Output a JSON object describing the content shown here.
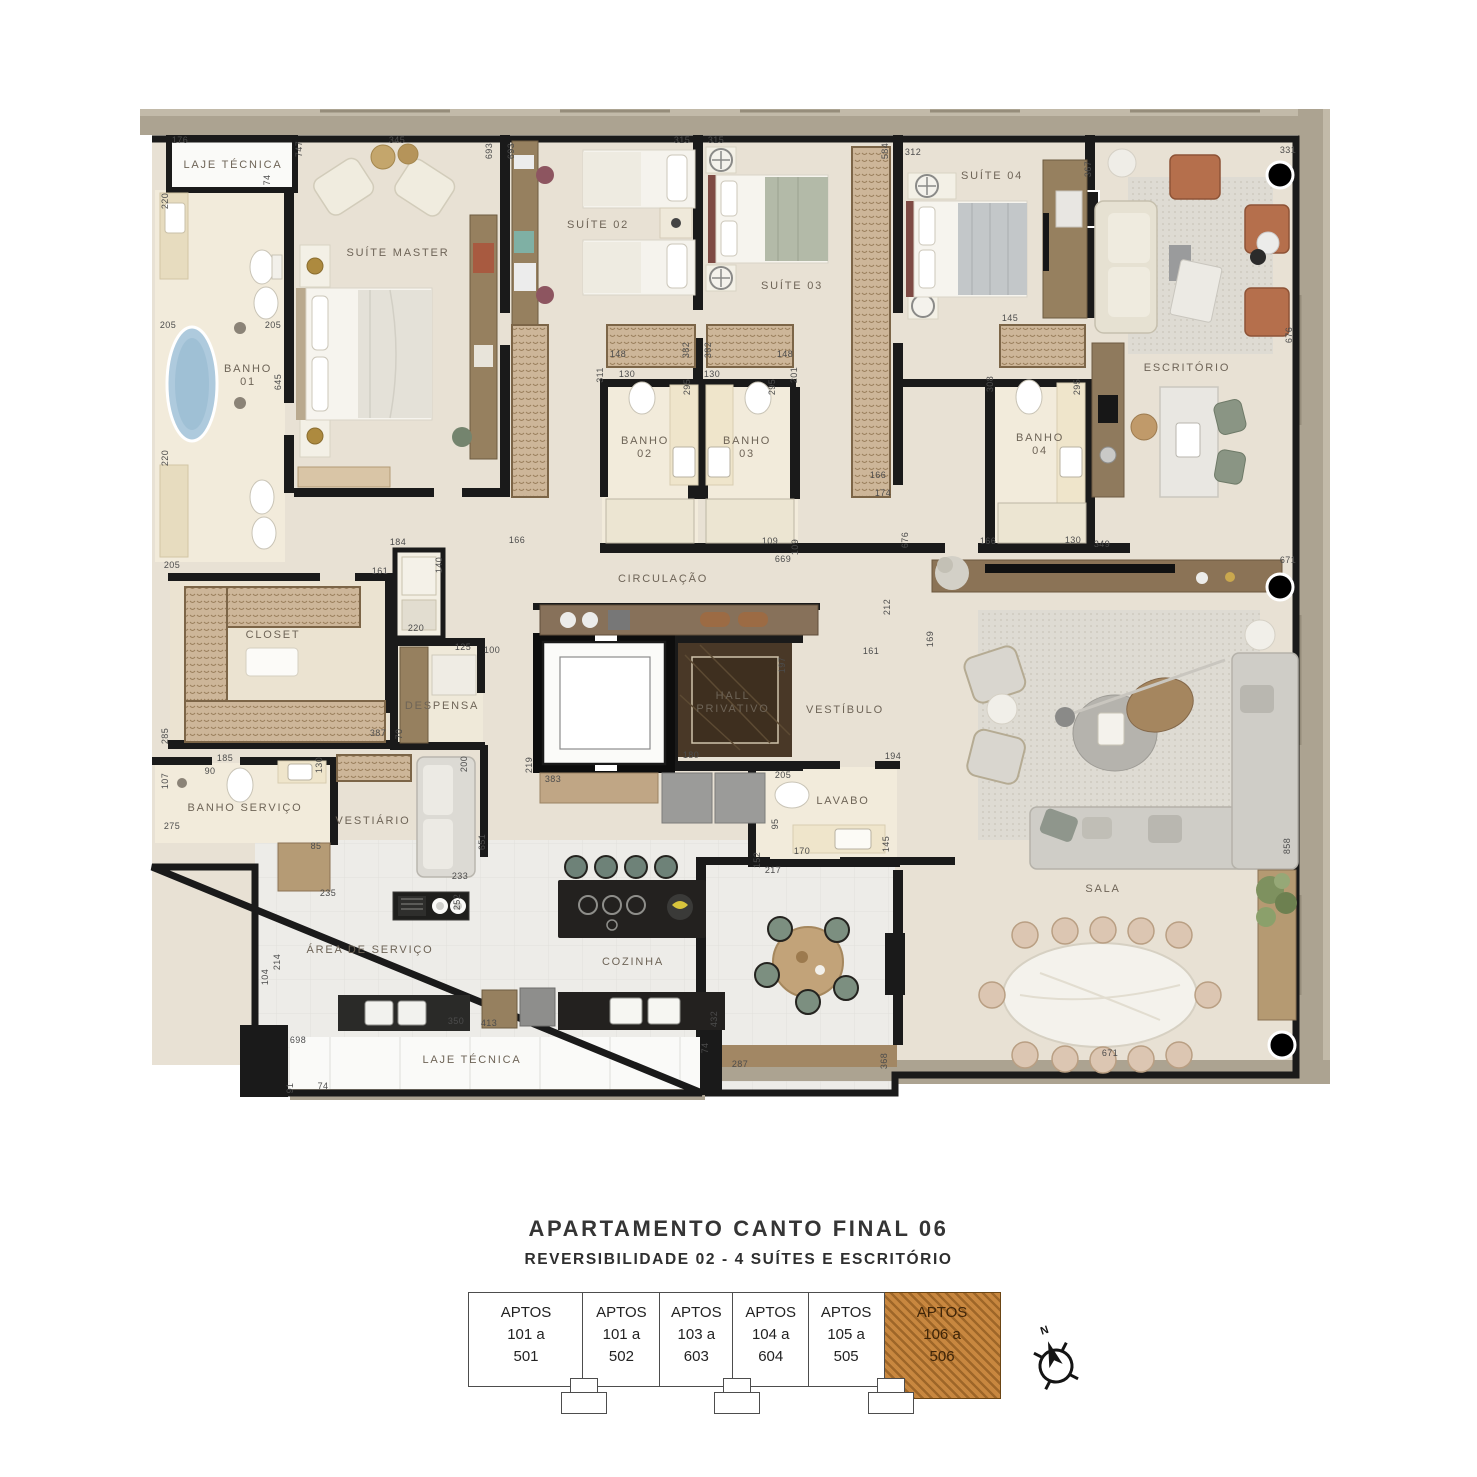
{
  "title": "APARTAMENTO CANTO FINAL 06",
  "subtitle": "REVERSIBILIDADE 02 -  4 SUÍTES E ESCRITÓRIO",
  "colors": {
    "floor": "#e8e1d4",
    "bath_floor": "#f2ebdb",
    "wall": "#1a1a1a",
    "facade": "#aca391",
    "wardrobe": "#cdb699",
    "wood": "#96805f",
    "highlight_orange": "#c8873f",
    "marble_hall": "#493827",
    "tub_blue": "#aecadd"
  },
  "plan": {
    "room_labels": [
      {
        "label": "LAJE TÉCNICA",
        "x": 93,
        "y": 73
      },
      {
        "label": "BANHO\n01",
        "x": 108,
        "y": 277
      },
      {
        "label": "SUÍTE MASTER",
        "x": 258,
        "y": 161
      },
      {
        "label": "SUÍTE 02",
        "x": 458,
        "y": 133
      },
      {
        "label": "SUÍTE 03",
        "x": 652,
        "y": 194
      },
      {
        "label": "SUÍTE 04",
        "x": 852,
        "y": 84
      },
      {
        "label": "ESCRITÓRIO",
        "x": 1047,
        "y": 276
      },
      {
        "label": "BANHO\n02",
        "x": 505,
        "y": 349
      },
      {
        "label": "BANHO\n03",
        "x": 607,
        "y": 349
      },
      {
        "label": "BANHO\n04",
        "x": 900,
        "y": 346
      },
      {
        "label": "CLOSET",
        "x": 133,
        "y": 543
      },
      {
        "label": "CIRCULAÇÃO",
        "x": 523,
        "y": 487
      },
      {
        "label": "DESPENSA",
        "x": 302,
        "y": 614
      },
      {
        "label": "HALL\nPRIVATIVO",
        "x": 593,
        "y": 604,
        "w": 1
      },
      {
        "label": "VESTÍBULO",
        "x": 705,
        "y": 618
      },
      {
        "label": "BANHO SERVIÇO",
        "x": 105,
        "y": 716
      },
      {
        "label": "VESTIÁRIO",
        "x": 233,
        "y": 729
      },
      {
        "label": "LAVABO",
        "x": 703,
        "y": 709
      },
      {
        "label": "ÁREA DE SERVIÇO",
        "x": 230,
        "y": 858
      },
      {
        "label": "COZINHA",
        "x": 493,
        "y": 870
      },
      {
        "label": "SALA",
        "x": 963,
        "y": 797
      },
      {
        "label": "LAJE TÉCNICA",
        "x": 332,
        "y": 968
      }
    ],
    "dims": [
      {
        "v": "176",
        "x": 40,
        "y": 48
      },
      {
        "v": "74",
        "x": 130,
        "y": 85,
        "r": 1
      },
      {
        "v": "747",
        "x": 162,
        "y": 54,
        "r": 1
      },
      {
        "v": "345",
        "x": 257,
        "y": 48
      },
      {
        "v": "693",
        "x": 352,
        "y": 56,
        "r": 1
      },
      {
        "v": "693",
        "x": 374,
        "y": 56,
        "r": 1
      },
      {
        "v": "315",
        "x": 542,
        "y": 48
      },
      {
        "v": "315",
        "x": 576,
        "y": 48
      },
      {
        "v": "584",
        "x": 748,
        "y": 56,
        "r": 1
      },
      {
        "v": "312",
        "x": 773,
        "y": 60
      },
      {
        "v": "367",
        "x": 951,
        "y": 74,
        "r": 1
      },
      {
        "v": "331",
        "x": 1148,
        "y": 58
      },
      {
        "v": "220",
        "x": 28,
        "y": 106,
        "r": 1
      },
      {
        "v": "205",
        "x": 28,
        "y": 233
      },
      {
        "v": "205",
        "x": 133,
        "y": 233
      },
      {
        "v": "645",
        "x": 141,
        "y": 287,
        "r": 1
      },
      {
        "v": "220",
        "x": 28,
        "y": 363,
        "r": 1
      },
      {
        "v": "205",
        "x": 32,
        "y": 473
      },
      {
        "v": "184",
        "x": 258,
        "y": 450
      },
      {
        "v": "161",
        "x": 240,
        "y": 479
      },
      {
        "v": "140",
        "x": 302,
        "y": 470,
        "r": 1
      },
      {
        "v": "220",
        "x": 276,
        "y": 536
      },
      {
        "v": "125",
        "x": 323,
        "y": 555
      },
      {
        "v": "100",
        "x": 352,
        "y": 558
      },
      {
        "v": "285",
        "x": 28,
        "y": 641,
        "r": 1
      },
      {
        "v": "387",
        "x": 238,
        "y": 641
      },
      {
        "v": "70",
        "x": 262,
        "y": 639,
        "r": 1
      },
      {
        "v": "107",
        "x": 28,
        "y": 686,
        "r": 1
      },
      {
        "v": "90",
        "x": 70,
        "y": 679
      },
      {
        "v": "185",
        "x": 85,
        "y": 666
      },
      {
        "v": "130",
        "x": 182,
        "y": 670,
        "r": 1
      },
      {
        "v": "275",
        "x": 32,
        "y": 734
      },
      {
        "v": "85",
        "x": 176,
        "y": 754
      },
      {
        "v": "235",
        "x": 188,
        "y": 801
      },
      {
        "v": "200",
        "x": 327,
        "y": 669,
        "r": 1
      },
      {
        "v": "233",
        "x": 320,
        "y": 784
      },
      {
        "v": "651",
        "x": 345,
        "y": 747,
        "r": 1
      },
      {
        "v": "252",
        "x": 320,
        "y": 807,
        "r": 1
      },
      {
        "v": "166",
        "x": 377,
        "y": 448
      },
      {
        "v": "148",
        "x": 478,
        "y": 262
      },
      {
        "v": "382",
        "x": 549,
        "y": 255,
        "r": 1
      },
      {
        "v": "311",
        "x": 463,
        "y": 280,
        "r": 1
      },
      {
        "v": "130",
        "x": 487,
        "y": 282
      },
      {
        "v": "295",
        "x": 550,
        "y": 292,
        "r": 1
      },
      {
        "v": "382",
        "x": 571,
        "y": 255,
        "r": 1
      },
      {
        "v": "148",
        "x": 645,
        "y": 262
      },
      {
        "v": "130",
        "x": 572,
        "y": 282
      },
      {
        "v": "295",
        "x": 635,
        "y": 292,
        "r": 1
      },
      {
        "v": "201",
        "x": 657,
        "y": 280,
        "r": 1
      },
      {
        "v": "109",
        "x": 630,
        "y": 449
      },
      {
        "v": "109",
        "x": 658,
        "y": 452,
        "r": 1
      },
      {
        "v": "669",
        "x": 643,
        "y": 467
      },
      {
        "v": "166",
        "x": 738,
        "y": 383
      },
      {
        "v": "174",
        "x": 743,
        "y": 401
      },
      {
        "v": "145",
        "x": 870,
        "y": 226
      },
      {
        "v": "308",
        "x": 853,
        "y": 289,
        "r": 1
      },
      {
        "v": "295",
        "x": 940,
        "y": 292,
        "r": 1
      },
      {
        "v": "676",
        "x": 768,
        "y": 445,
        "r": 1
      },
      {
        "v": "166",
        "x": 848,
        "y": 449
      },
      {
        "v": "130",
        "x": 933,
        "y": 448
      },
      {
        "v": "349",
        "x": 962,
        "y": 452
      },
      {
        "v": "671",
        "x": 1148,
        "y": 468
      },
      {
        "v": "212",
        "x": 750,
        "y": 512,
        "r": 1
      },
      {
        "v": "169",
        "x": 793,
        "y": 544,
        "r": 1
      },
      {
        "v": "161",
        "x": 731,
        "y": 559
      },
      {
        "v": "197",
        "x": 645,
        "y": 570,
        "r": 1,
        "w": 1
      },
      {
        "v": "180",
        "x": 551,
        "y": 663,
        "w": 1
      },
      {
        "v": "219",
        "x": 392,
        "y": 670,
        "r": 1
      },
      {
        "v": "383",
        "x": 413,
        "y": 687
      },
      {
        "v": "205",
        "x": 643,
        "y": 683
      },
      {
        "v": "95",
        "x": 638,
        "y": 729,
        "r": 1
      },
      {
        "v": "152",
        "x": 620,
        "y": 765,
        "r": 1
      },
      {
        "v": "170",
        "x": 662,
        "y": 759
      },
      {
        "v": "145",
        "x": 749,
        "y": 749,
        "r": 1
      },
      {
        "v": "194",
        "x": 753,
        "y": 664
      },
      {
        "v": "217",
        "x": 633,
        "y": 778
      },
      {
        "v": "214",
        "x": 140,
        "y": 867,
        "r": 1
      },
      {
        "v": "104",
        "x": 128,
        "y": 882,
        "r": 1
      },
      {
        "v": "350",
        "x": 316,
        "y": 929,
        "w": 1
      },
      {
        "v": "413",
        "x": 349,
        "y": 931
      },
      {
        "v": "432",
        "x": 577,
        "y": 924,
        "r": 1,
        "w": 1
      },
      {
        "v": "698",
        "x": 158,
        "y": 948
      },
      {
        "v": "74",
        "x": 568,
        "y": 953,
        "r": 1,
        "w": 1
      },
      {
        "v": "91",
        "x": 153,
        "y": 993,
        "r": 1
      },
      {
        "v": "74",
        "x": 183,
        "y": 994
      },
      {
        "v": "287",
        "x": 600,
        "y": 972
      },
      {
        "v": "368",
        "x": 747,
        "y": 966,
        "r": 1
      },
      {
        "v": "671",
        "x": 970,
        "y": 961
      },
      {
        "v": "858",
        "x": 1150,
        "y": 751,
        "r": 1
      },
      {
        "v": "676",
        "x": 1152,
        "y": 240,
        "r": 1
      }
    ]
  },
  "keyplan": {
    "units": [
      {
        "l1": "APTOS",
        "l2": "101 a",
        "l3": "501",
        "highlight": false
      },
      {
        "l1": "APTOS",
        "l2": "101 a",
        "l3": "502",
        "highlight": false
      },
      {
        "l1": "APTOS",
        "l2": "103 a",
        "l3": "603",
        "highlight": false
      },
      {
        "l1": "APTOS",
        "l2": "104 a",
        "l3": "604",
        "highlight": false
      },
      {
        "l1": "APTOS",
        "l2": "105 a",
        "l3": "505",
        "highlight": false
      },
      {
        "l1": "APTOS",
        "l2": "106 a",
        "l3": "506",
        "highlight": true
      }
    ]
  },
  "compass": {
    "north_label": "N"
  }
}
